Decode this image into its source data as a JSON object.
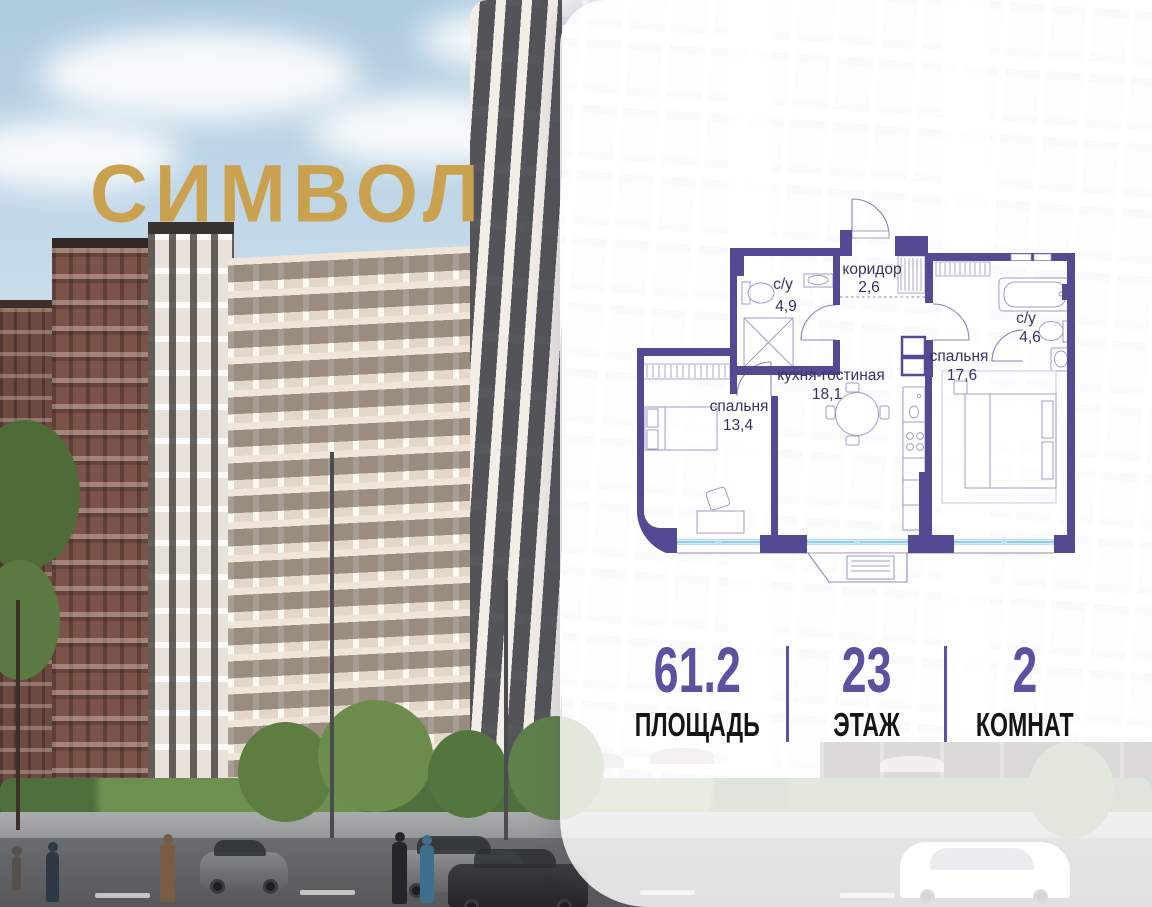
{
  "brand": {
    "logo_text": "СИМВОЛ",
    "logo_color": "#C9A14F"
  },
  "floor_plan": {
    "wall_color": "#544A93",
    "glazing_color": "#A9D9F2",
    "label_color": "#3A3264",
    "rooms": [
      {
        "name": "коридор",
        "area": "2,6"
      },
      {
        "name": "с/у",
        "area": "4,9"
      },
      {
        "name": "кухня-гостиная",
        "area": "18,1"
      },
      {
        "name": "спальня",
        "area": "13,4"
      },
      {
        "name": "спальня",
        "area": "17,6"
      },
      {
        "name": "с/у",
        "area": "4,6"
      }
    ]
  },
  "stats": {
    "accent_color": "#5B53A0",
    "items": [
      {
        "value": "61.2",
        "label": "ПЛОЩАДЬ"
      },
      {
        "value": "23",
        "label": "ЭТАЖ"
      },
      {
        "value": "2",
        "label": "КОМНАТ"
      }
    ]
  },
  "street": {
    "storefront_sign": "БАРБЕРШОП"
  }
}
